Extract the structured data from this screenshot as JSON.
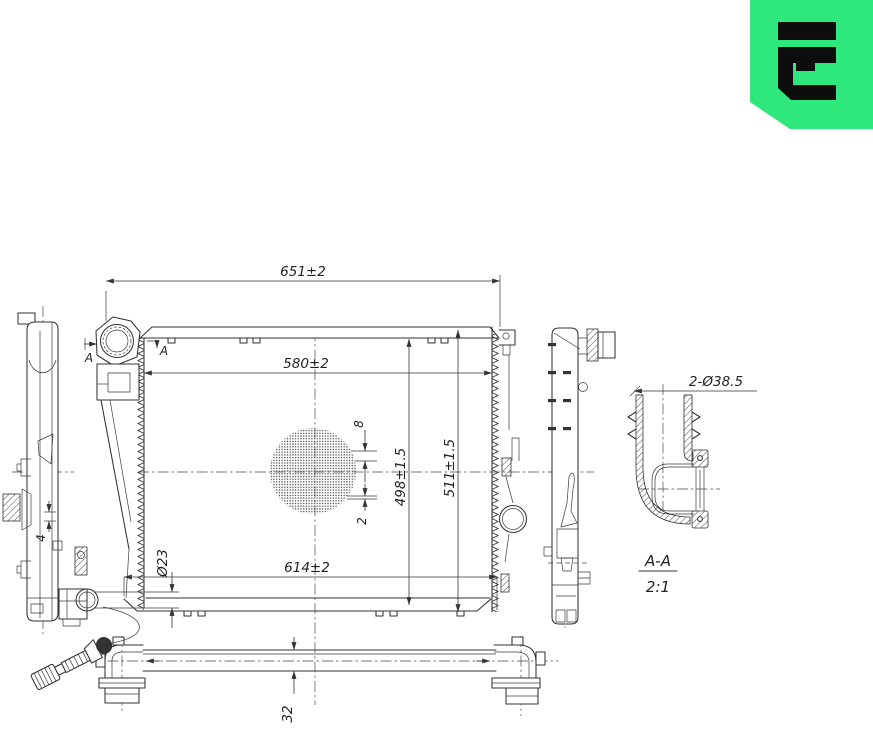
{
  "logo": {
    "bg_color": "#2ee87b",
    "glyph_color": "#0d0d0d"
  },
  "drawing": {
    "line_color": "#333333",
    "dims": {
      "overall_width": "651±2",
      "core_width": "580±2",
      "lower_width": "614±2",
      "core_height": "498±1.5",
      "overall_height": "511±1.5",
      "fin_pitch": "8",
      "fin_thickness": "2",
      "drain_diameter": "Ø23",
      "bracket_gap": "4",
      "tube_height": "32",
      "port_diameter": "2-Ø38.5"
    },
    "section": {
      "label": "A-A",
      "scale": "2:1",
      "cut_marker": "A"
    }
  }
}
